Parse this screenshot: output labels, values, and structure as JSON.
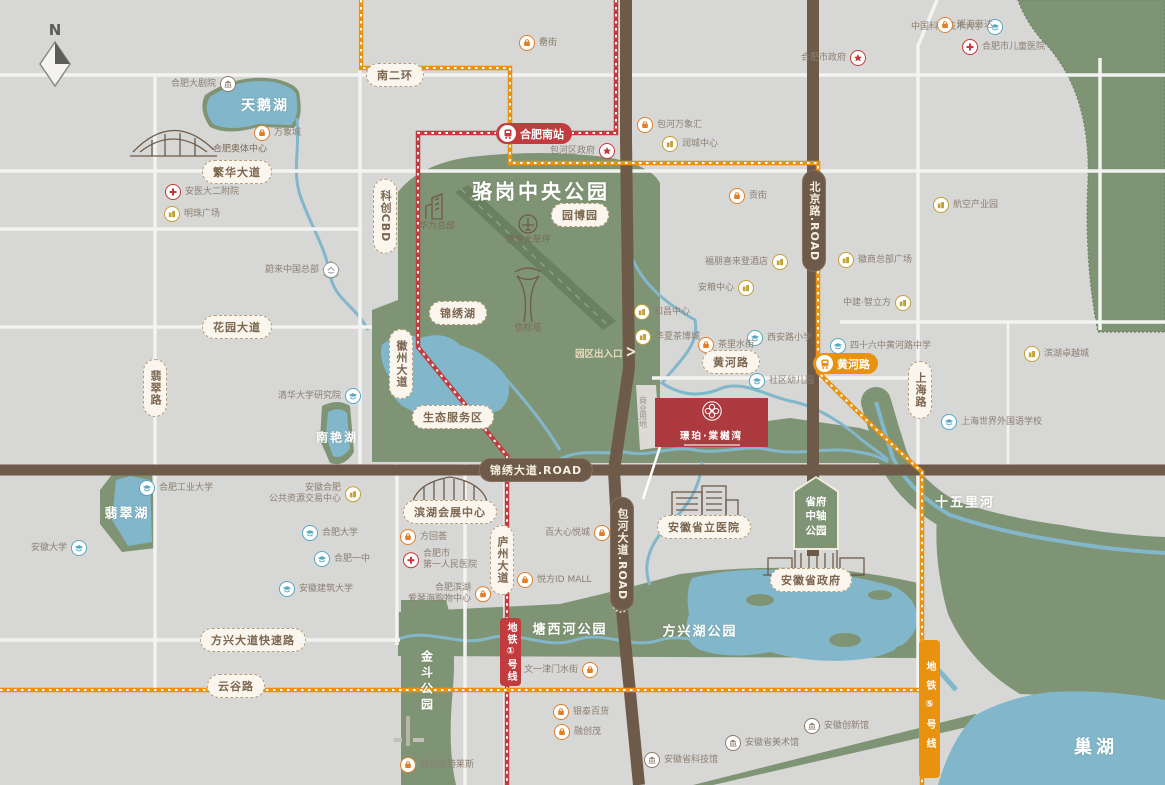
{
  "compass": {
    "n": "N"
  },
  "project": {
    "name": "璟珀·棠樾湾",
    "land_use": "商业用地"
  },
  "stations": {
    "hefei_south": "合肥南站",
    "huanghe_stop": "黄河路",
    "line1": "地铁①号线",
    "line5": "地铁⑤号线"
  },
  "shield": {
    "l1": "省府",
    "l2": "中轴",
    "l3": "公园"
  },
  "gate": {
    "label": "园区出入口",
    "arrow": ">"
  },
  "colors": {
    "metro_line1_red": "#c23b3f",
    "metro_line5_orange": "#e8920f",
    "park_green": "#7f9474",
    "water_blue": "#82b7cb",
    "road_brown": "#6e5a49",
    "project_red": "#ac3a3e"
  },
  "road_pills": [
    {
      "t": "南二环",
      "x": 395,
      "y": 75
    },
    {
      "t": "繁华大道",
      "x": 237,
      "y": 172
    },
    {
      "t": "花园大道",
      "x": 237,
      "y": 327
    },
    {
      "t": "翡翠路",
      "x": 155,
      "y": 388,
      "v": 1
    },
    {
      "t": "徽州大道",
      "x": 401,
      "y": 364,
      "v": 1
    },
    {
      "t": "科创CBD",
      "x": 385,
      "y": 216,
      "v": 1
    },
    {
      "t": "锦绣湖",
      "x": 458,
      "y": 313
    },
    {
      "t": "园博园",
      "x": 580,
      "y": 215
    },
    {
      "t": "生态服务区",
      "x": 453,
      "y": 417
    },
    {
      "t": "黄河路",
      "x": 731,
      "y": 362
    },
    {
      "t": "上海路",
      "x": 920,
      "y": 390,
      "v": 1
    },
    {
      "t": "庐州大道",
      "x": 502,
      "y": 560,
      "v": 1
    },
    {
      "t": "方兴大道快速路",
      "x": 253,
      "y": 640
    },
    {
      "t": "云谷路",
      "x": 236,
      "y": 686
    },
    {
      "t": "滨湖会展中心",
      "x": 450,
      "y": 512
    },
    {
      "t": "安徽省立医院",
      "x": 704,
      "y": 527
    },
    {
      "t": "安徽省政府",
      "x": 811,
      "y": 580
    },
    {
      "t": "锦绣大道.ROAD",
      "x": 536,
      "y": 470,
      "st": "brown"
    },
    {
      "t": "包河大道.ROAD",
      "x": 622,
      "y": 554,
      "v": 1,
      "st": "brown"
    },
    {
      "t": "北京路.ROAD",
      "x": 814,
      "y": 221,
      "v": 1,
      "st": "brown"
    }
  ],
  "area_labels": [
    {
      "t": "骆岗中央公园",
      "x": 541,
      "y": 190,
      "s": 20,
      "ls": 3
    },
    {
      "t": "天鹅湖",
      "x": 265,
      "y": 105,
      "s": 14,
      "ls": 2
    },
    {
      "t": "翡翠湖",
      "x": 127,
      "y": 512,
      "s": 13,
      "ls": 2
    },
    {
      "t": "南艳湖",
      "x": 337,
      "y": 437,
      "s": 12,
      "ls": 2
    },
    {
      "t": "十五里河",
      "x": 965,
      "y": 501,
      "s": 13,
      "ls": 2
    },
    {
      "t": "塘西河公园",
      "x": 570,
      "y": 628,
      "s": 13,
      "ls": 2
    },
    {
      "t": "方兴湖公园",
      "x": 700,
      "y": 630,
      "s": 13,
      "ls": 2
    },
    {
      "t": "金斗公园",
      "x": 427,
      "y": 682,
      "s": 12,
      "ls": 4,
      "v": 1
    },
    {
      "t": "巢湖",
      "x": 1096,
      "y": 746,
      "s": 18,
      "ls": 4
    }
  ],
  "captions": [
    {
      "t": "华为总部",
      "x": 437,
      "y": 225,
      "s": 9
    },
    {
      "t": "梦想大草坪",
      "x": 528,
      "y": 239,
      "s": 9
    },
    {
      "t": "信标塔",
      "x": 528,
      "y": 327,
      "s": 9
    },
    {
      "t": "合肥奥体中心",
      "x": 240,
      "y": 148,
      "s": 9
    },
    {
      "t": "商业用地",
      "x": 643,
      "y": 412,
      "s": 8,
      "v": 1,
      "c": "g"
    }
  ],
  "pois": [
    {
      "t": "中国科学技术大学",
      "x": 995,
      "y": 27,
      "tp": "school",
      "sd": "left"
    },
    {
      "t": "清华大学研究院",
      "x": 353,
      "y": 396,
      "tp": "school",
      "sd": "left"
    },
    {
      "t": "合肥工业大学",
      "x": 147,
      "y": 488,
      "tp": "school",
      "sd": "right"
    },
    {
      "t": "安徽大学",
      "x": 79,
      "y": 548,
      "tp": "school",
      "sd": "left"
    },
    {
      "t": "合肥大学",
      "x": 310,
      "y": 533,
      "tp": "school",
      "sd": "right"
    },
    {
      "t": "合肥一中",
      "x": 322,
      "y": 559,
      "tp": "school",
      "sd": "right"
    },
    {
      "t": "安徽建筑大学",
      "x": 287,
      "y": 589,
      "tp": "school",
      "sd": "right"
    },
    {
      "t": "西安路小学",
      "x": 755,
      "y": 338,
      "tp": "school",
      "sd": "right"
    },
    {
      "t": "四十六中黄河路中学",
      "x": 838,
      "y": 346,
      "tp": "school",
      "sd": "right"
    },
    {
      "t": "社区幼儿园",
      "x": 757,
      "y": 381,
      "tp": "school",
      "sd": "right"
    },
    {
      "t": "上海世界外国语学校",
      "x": 949,
      "y": 422,
      "tp": "school",
      "sd": "right"
    },
    {
      "t": "合肥市政府",
      "x": 858,
      "y": 58,
      "tp": "gov",
      "sd": "left"
    },
    {
      "t": "包河区政府",
      "x": 607,
      "y": 151,
      "tp": "gov",
      "sd": "left"
    },
    {
      "t": "安医大二附院",
      "x": 173,
      "y": 192,
      "tp": "hosp",
      "sd": "right"
    },
    {
      "t": "合肥市儿童医院",
      "x": 970,
      "y": 47,
      "tp": "hosp",
      "sd": "right"
    },
    {
      "t": "合肥市",
      "t2": "第一人民医院",
      "x": 411,
      "y": 560,
      "tp": "hosp",
      "sd": "right"
    },
    {
      "t": "万象城",
      "x": 262,
      "y": 133,
      "tp": "shop",
      "sd": "right"
    },
    {
      "t": "罍街",
      "x": 527,
      "y": 43,
      "tp": "shop",
      "sd": "right"
    },
    {
      "t": "包河万象汇",
      "x": 645,
      "y": 125,
      "tp": "shop",
      "sd": "right"
    },
    {
      "t": "贡街",
      "x": 737,
      "y": 196,
      "tp": "shop",
      "sd": "right"
    },
    {
      "t": "茶里水街",
      "x": 706,
      "y": 345,
      "tp": "shop",
      "sd": "right"
    },
    {
      "t": "方回荟",
      "x": 408,
      "y": 537,
      "tp": "shop",
      "sd": "right"
    },
    {
      "t": "悦方ID MALL",
      "x": 525,
      "y": 580,
      "tp": "shop",
      "sd": "right"
    },
    {
      "t": "百大心悦城",
      "x": 602,
      "y": 533,
      "tp": "shop",
      "sd": "left"
    },
    {
      "t": "合肥滨湖",
      "t2": "爱琴海购物中心",
      "x": 483,
      "y": 594,
      "tp": "shop",
      "sd": "left"
    },
    {
      "t": "银泰百货",
      "x": 561,
      "y": 712,
      "tp": "shop",
      "sd": "right"
    },
    {
      "t": "融创茂",
      "x": 562,
      "y": 732,
      "tp": "shop",
      "sd": "right"
    },
    {
      "t": "首创奥特莱斯",
      "x": 408,
      "y": 765,
      "tp": "shop",
      "sd": "right"
    },
    {
      "t": "文一津门水街",
      "x": 590,
      "y": 670,
      "tp": "shop",
      "sd": "left"
    },
    {
      "t": "瑶海万达",
      "x": 945,
      "y": 25,
      "tp": "shop",
      "sd": "right"
    },
    {
      "t": "明珠广场",
      "x": 172,
      "y": 214,
      "tp": "biz",
      "sd": "right"
    },
    {
      "t": "润城中心",
      "x": 670,
      "y": 144,
      "tp": "biz",
      "sd": "right"
    },
    {
      "t": "航空产业园",
      "x": 941,
      "y": 205,
      "tp": "biz",
      "sd": "right"
    },
    {
      "t": "福朋喜来登酒店",
      "x": 780,
      "y": 262,
      "tp": "biz",
      "sd": "left"
    },
    {
      "t": "徽商总部广场",
      "x": 846,
      "y": 260,
      "tp": "biz",
      "sd": "right"
    },
    {
      "t": "安粮中心",
      "x": 746,
      "y": 288,
      "tp": "biz",
      "sd": "left"
    },
    {
      "t": "和昌中心",
      "x": 642,
      "y": 312,
      "tp": "biz",
      "sd": "right"
    },
    {
      "t": "华夏茶博城",
      "x": 643,
      "y": 337,
      "tp": "biz",
      "sd": "right"
    },
    {
      "t": "中建·智立方",
      "x": 903,
      "y": 303,
      "tp": "biz",
      "sd": "left"
    },
    {
      "t": "滨湖卓越城",
      "x": 1032,
      "y": 354,
      "tp": "biz",
      "sd": "right"
    },
    {
      "t": "安徽合肥",
      "t2": "公共资源交易中心",
      "x": 353,
      "y": 494,
      "tp": "biz",
      "sd": "left"
    },
    {
      "t": "安徽创新馆",
      "x": 812,
      "y": 726,
      "tp": "mus",
      "sd": "right"
    },
    {
      "t": "安徽省美术馆",
      "x": 733,
      "y": 743,
      "tp": "mus",
      "sd": "right"
    },
    {
      "t": "安徽省科技馆",
      "x": 652,
      "y": 760,
      "tp": "mus",
      "sd": "right"
    },
    {
      "t": "合肥大剧院",
      "x": 228,
      "y": 84,
      "tp": "mus",
      "sd": "left"
    },
    {
      "t": "蔚来中国总部",
      "x": 331,
      "y": 270,
      "tp": "nio",
      "sd": "left"
    }
  ]
}
